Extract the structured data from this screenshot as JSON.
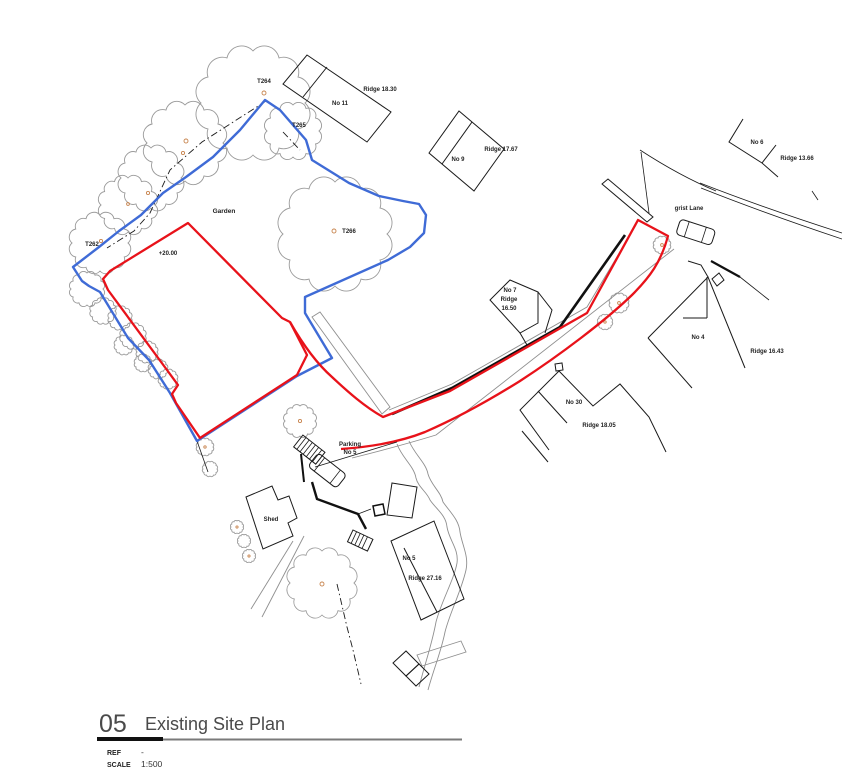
{
  "title_block": {
    "number": "05",
    "title": "Existing Site Plan",
    "ref_label": "REF",
    "ref_value": "-",
    "scale_label": "SCALE",
    "scale_value": "1:500"
  },
  "labels": {
    "garden": "Garden",
    "spot_level": "+20.00",
    "grist_lane": "grist Lane",
    "parking_line1": "Parking",
    "parking_line2": "No 5",
    "shed": "Shed",
    "trees": {
      "t262": "T262",
      "t264": "T264",
      "t265": "T265",
      "t266": "T266"
    },
    "houses": {
      "no11": {
        "name": "No 11",
        "ridge": "Ridge 18.30"
      },
      "no9": {
        "name": "No 9",
        "ridge": "Ridge 17.67"
      },
      "no6": {
        "name": "No 6",
        "ridge": "Ridge 13.66"
      },
      "no7": {
        "name": "No 7",
        "ridge_line1": "Ridge",
        "ridge_line2": "16.50"
      },
      "no4": {
        "name": "No 4",
        "ridge": "Ridge 16.43"
      },
      "no30": {
        "name": "No 30",
        "ridge": "Ridge 18.05"
      },
      "no5": {
        "name": "No 5",
        "ridge": "Ridge 27.16"
      }
    }
  },
  "colors": {
    "site_boundary_red": "#e8121a",
    "garden_boundary_blue": "#3f6bd6",
    "tree_outline_gray": "#9a9a9a",
    "tree_center_orange": "#c8854f"
  }
}
